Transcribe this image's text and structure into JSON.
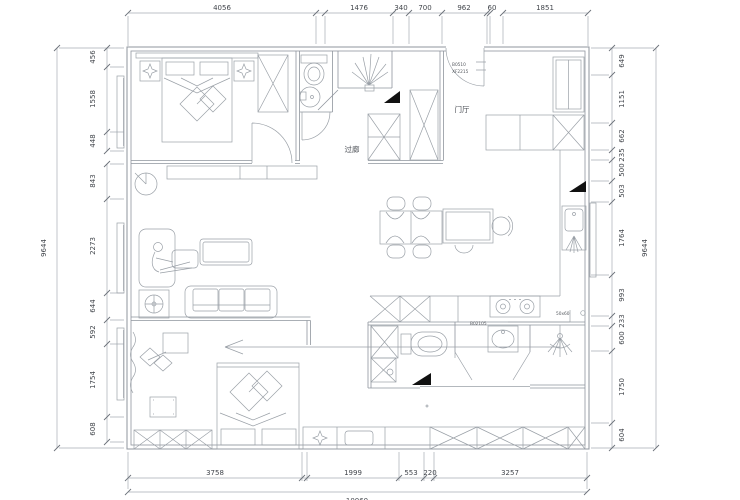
{
  "dimensions": {
    "top": [
      "4056",
      "1476",
      "340",
      "700",
      "962",
      "60",
      "1851"
    ],
    "bottom": [
      "3758",
      "1999",
      "553",
      "220",
      "3257"
    ],
    "bottom_total": "10060",
    "left": [
      "456",
      "1558",
      "448",
      "843",
      "2273",
      "644",
      "592",
      "1754",
      "608"
    ],
    "left_total": "9644",
    "right": [
      "649",
      "1151",
      "662",
      "235",
      "500",
      "503",
      "1764",
      "993",
      "233",
      "600",
      "1750",
      "604"
    ],
    "right_total": "9644"
  },
  "labels": {
    "corridor": "过廊",
    "foyer": "门厅"
  },
  "tags": {
    "entry_door_line1": "B0510",
    "entry_door_line2": "XF2215",
    "stove": "B02105",
    "floor_drain": "50x60"
  },
  "colors": {
    "background": "#ffffff",
    "wall_line": "#8f959d",
    "furniture_line": "#9aa0a7",
    "dimension_line": "#a9aeb5",
    "dimension_text": "#42464c",
    "marker_fill": "#111111"
  }
}
